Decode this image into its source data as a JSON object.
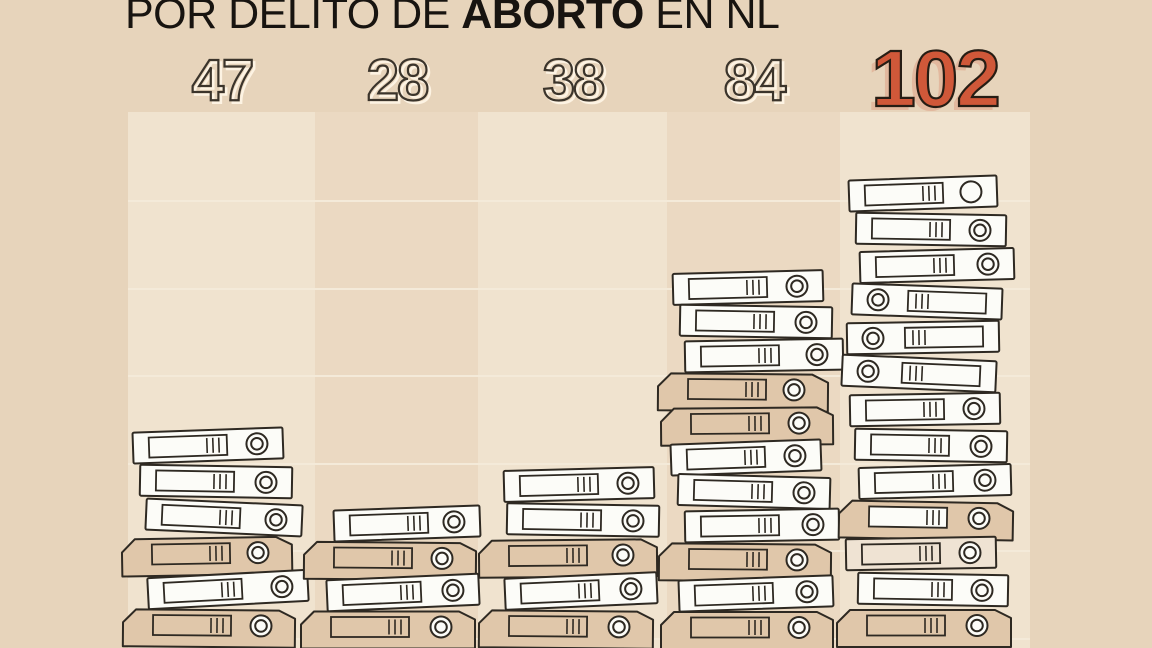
{
  "title": {
    "prefix": "POR DELITO DE ",
    "bold": "ABORTO",
    "suffix": " EN NL"
  },
  "chart_data": {
    "type": "bar",
    "title": "POR DELITO DE ABORTO EN NL",
    "categories": [
      "",
      "",
      "",
      "",
      ""
    ],
    "values": [
      47,
      28,
      38,
      84,
      102
    ],
    "highlight_index": 4,
    "pictogram": "stacks of ring binders",
    "binders_per_stack": [
      6,
      4,
      5,
      11,
      13
    ],
    "gridlines": true,
    "value_labels_position": "above bars"
  },
  "colors": {
    "bg": "#e7d4bb",
    "col_light": "#f0e3cf",
    "col_mid": "#ebd9c2",
    "grid": "#f4ead9",
    "ink": "#181410",
    "outline": "#2e2922",
    "number_stroke": "#3b342b",
    "number_shadow": "#fdf3e3",
    "binder_white": "#fcfcf8",
    "binder_tan": "#e0c7aa",
    "binder_cream": "#efe3d3",
    "highlight": "#d05839",
    "highlight_stroke": "#261d14",
    "highlight_shadow": "#e2b89e"
  },
  "stacks": [
    {
      "value": "47",
      "slot": 36,
      "binders": [
        {
          "style": "white",
          "ring": "right",
          "dx": -14,
          "w": 150,
          "tilt": -2
        },
        {
          "style": "white",
          "ring": "right",
          "dx": -6,
          "w": 152,
          "tilt": 1
        },
        {
          "style": "white",
          "ring": "right",
          "dx": 2,
          "w": 156,
          "tilt": 2.5
        },
        {
          "style": "tan",
          "ring": "right",
          "dx": -12,
          "w": 148,
          "tilt": -1
        },
        {
          "style": "white",
          "ring": "right",
          "dx": 6,
          "w": 160,
          "tilt": -3
        },
        {
          "style": "tan",
          "ring": "right",
          "dx": -10,
          "w": 150,
          "tilt": 0.5
        }
      ]
    },
    {
      "value": "28",
      "slot": 34.5,
      "binders": [
        {
          "style": "white",
          "ring": "right",
          "dx": 10,
          "w": 146,
          "tilt": -2
        },
        {
          "style": "tan",
          "ring": "right",
          "dx": -4,
          "w": 150,
          "tilt": 0.5
        },
        {
          "style": "white",
          "ring": "right",
          "dx": 6,
          "w": 152,
          "tilt": -2.5
        },
        {
          "style": "tan",
          "ring": "right",
          "dx": -6,
          "w": 152,
          "tilt": 0
        }
      ]
    },
    {
      "value": "38",
      "slot": 35.5,
      "binders": [
        {
          "style": "white",
          "ring": "right",
          "dx": 6,
          "w": 150,
          "tilt": -1.5
        },
        {
          "style": "white",
          "ring": "right",
          "dx": 10,
          "w": 152,
          "tilt": 1
        },
        {
          "style": "tan",
          "ring": "right",
          "dx": -2,
          "w": 156,
          "tilt": -0.5
        },
        {
          "style": "white",
          "ring": "right",
          "dx": 8,
          "w": 152,
          "tilt": -2.5
        },
        {
          "style": "tan",
          "ring": "right",
          "dx": -4,
          "w": 152,
          "tilt": 0.5
        }
      ]
    },
    {
      "value": "84",
      "slot": 34,
      "binders": [
        {
          "style": "white",
          "ring": "right",
          "dx": -6,
          "w": 150,
          "tilt": -1.5
        },
        {
          "style": "white",
          "ring": "right",
          "dx": 2,
          "w": 152,
          "tilt": 1
        },
        {
          "style": "white",
          "ring": "right",
          "dx": 10,
          "w": 158,
          "tilt": -1
        },
        {
          "style": "tan",
          "ring": "right",
          "dx": -8,
          "w": 148,
          "tilt": 0.5
        },
        {
          "style": "tan",
          "ring": "right",
          "dx": -4,
          "w": 150,
          "tilt": -0.5
        },
        {
          "style": "white",
          "ring": "right",
          "dx": -8,
          "w": 150,
          "tilt": -2
        },
        {
          "style": "white",
          "ring": "right",
          "dx": 0,
          "w": 152,
          "tilt": 1.5
        },
        {
          "style": "white",
          "ring": "right",
          "dx": 8,
          "w": 154,
          "tilt": -1
        },
        {
          "style": "tan",
          "ring": "right",
          "dx": -6,
          "w": 150,
          "tilt": 0.5
        },
        {
          "style": "white",
          "ring": "right",
          "dx": 2,
          "w": 154,
          "tilt": -2
        },
        {
          "style": "tan",
          "ring": "right",
          "dx": -4,
          "w": 150,
          "tilt": 0
        }
      ]
    },
    {
      "value": "102",
      "slot": 36,
      "binders": [
        {
          "style": "white",
          "ring": "right",
          "ringStyle": "plain",
          "dx": -12,
          "w": 148,
          "tilt": -2
        },
        {
          "style": "white",
          "ring": "right",
          "dx": -4,
          "w": 150,
          "tilt": 1
        },
        {
          "style": "white",
          "ring": "right",
          "dx": 2,
          "w": 154,
          "tilt": -1.5
        },
        {
          "style": "white",
          "ring": "left",
          "dx": -8,
          "w": 150,
          "tilt": 2
        },
        {
          "style": "white",
          "ring": "left",
          "dx": -12,
          "w": 152,
          "tilt": -1
        },
        {
          "style": "white",
          "ring": "left",
          "dx": -16,
          "w": 154,
          "tilt": 2.5
        },
        {
          "style": "white",
          "ring": "right",
          "dx": -10,
          "w": 150,
          "tilt": -1
        },
        {
          "style": "white",
          "ring": "right",
          "dx": -4,
          "w": 152,
          "tilt": 1
        },
        {
          "style": "white",
          "ring": "right",
          "dx": 0,
          "w": 152,
          "tilt": -1.5
        },
        {
          "style": "tan",
          "ring": "right",
          "label": "white",
          "dx": -6,
          "w": 152,
          "tilt": 1
        },
        {
          "style": "cream",
          "ring": "right",
          "dx": -14,
          "w": 150,
          "tilt": -1
        },
        {
          "style": "white",
          "ring": "right",
          "dx": -2,
          "w": 150,
          "tilt": 1
        },
        {
          "style": "tan",
          "ring": "right",
          "dx": -8,
          "w": 152,
          "tilt": 0
        }
      ]
    }
  ]
}
